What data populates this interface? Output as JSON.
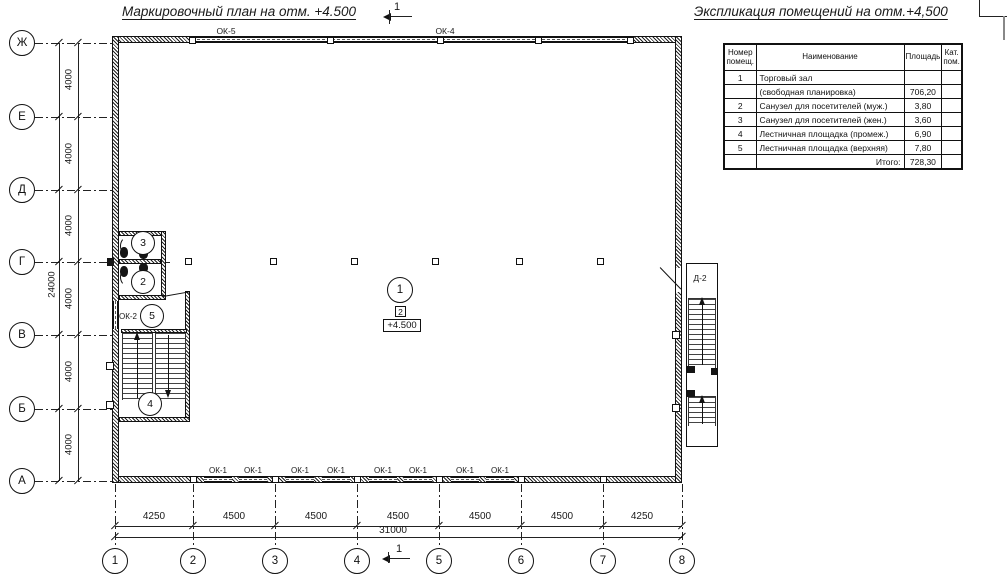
{
  "titles": {
    "plan": "Маркировочный план на отм. +4.500",
    "schedule": "Экспликация помещений на отм.+4,500"
  },
  "section_marker": "1",
  "schedule_table": {
    "headers": [
      "Номер помещ.",
      "Наименование",
      "Площадь",
      "Кат. пом."
    ],
    "rows": [
      [
        "1",
        "Торговый зал",
        "",
        ""
      ],
      [
        "",
        "(свободная планировка)",
        "706,20",
        ""
      ],
      [
        "2",
        "Санузел для посетителей (муж.)",
        "3,80",
        ""
      ],
      [
        "3",
        "Санузел для посетителей (жен.)",
        "3,60",
        ""
      ],
      [
        "4",
        "Лестничная площадка (промеж.)",
        "6,90",
        ""
      ],
      [
        "5",
        "Лестничная площадка (верхняя)",
        "7,80",
        ""
      ],
      [
        "",
        "Итого:",
        "728,30",
        ""
      ]
    ]
  },
  "row_axes": {
    "labels": [
      "Ж",
      "Е",
      "Д",
      "Г",
      "В",
      "Б",
      "А"
    ],
    "dims": [
      "4000",
      "4000",
      "4000",
      "4000",
      "4000",
      "4000"
    ],
    "total": "24000"
  },
  "col_axes": {
    "labels": [
      "1",
      "2",
      "3",
      "4",
      "5",
      "6",
      "7",
      "8"
    ],
    "dims": [
      "4250",
      "4500",
      "4500",
      "4500",
      "4500",
      "4500",
      "4250"
    ],
    "total": "31000"
  },
  "windows": {
    "ok5": "ОК-5",
    "ok4": "ОК-4",
    "ok2": "ОК-2",
    "ok1": [
      "ОК-1",
      "ОК-1",
      "ОК-1",
      "ОК-1",
      "ОК-1",
      "ОК-1",
      "ОК-1",
      "ОК-1"
    ]
  },
  "door": {
    "d2": "Д-2"
  },
  "rooms": {
    "r1": "1",
    "r2": "2",
    "r3": "3",
    "r4": "4",
    "r5": "5"
  },
  "markers": {
    "plan_number": "2",
    "elevation": "+4.500"
  },
  "colors": {
    "line": "#111111",
    "background": "#ffffff"
  }
}
